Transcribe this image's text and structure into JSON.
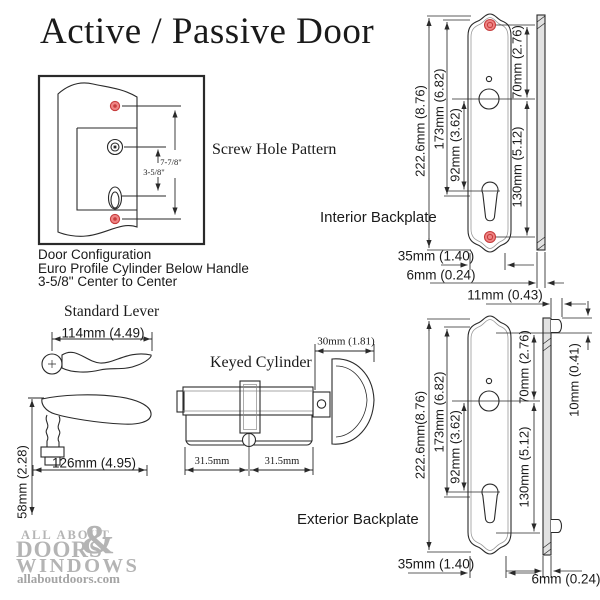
{
  "title": "Active / Passive Door",
  "screw_pattern": {
    "label": "Screw Hole Pattern",
    "dim_outer": "7-7/8\"",
    "dim_inner": "3-5/8\""
  },
  "door_config": {
    "line1": "Door Configuration",
    "line2": "Euro Profile Cylinder Below Handle",
    "line3": "3-5/8\" Center to Center"
  },
  "lever": {
    "label": "Standard Lever",
    "dim_width_top": "114mm (4.49)",
    "dim_length": "126mm (4.95)",
    "dim_height": "58mm (2.28)"
  },
  "cylinder": {
    "label": "Keyed Cylinder",
    "dim_thumbturn": "30mm (1.81)",
    "dim_left_half": "31.5mm",
    "dim_right_half": "31.5mm"
  },
  "interior_backplate": {
    "label": "Interior Backplate",
    "dim_overall_height": "222.6mm (8.76)",
    "dim_screw_spacing": "173mm (6.82)",
    "dim_handle_to_cylinder": "92mm (3.62)",
    "dim_top_to_handle": "70mm (2.76)",
    "dim_handle_to_bottom": "130mm (5.12)",
    "dim_width": "35mm (1.40)",
    "dim_thickness": "6mm (0.24)"
  },
  "exterior_backplate": {
    "label": "Exterior Backplate",
    "dim_overall_height": "222.6mm(8.76)",
    "dim_screw_spacing": "173mm (6.82)",
    "dim_handle_to_cylinder": "92mm (3.62)",
    "dim_top_to_handle": "70mm (2.76)",
    "dim_handle_to_bottom": "130mm (5.12)",
    "dim_width": "35mm (1.40)",
    "dim_thickness": "6mm (0.24)",
    "dim_tab_protrusion": "11mm (0.43)",
    "dim_tab_height": "10mm (0.41)"
  },
  "logo": {
    "line1": "ALL ABOUT",
    "line2": "DOORS",
    "ampersand": "&",
    "line3": "WINDOWS",
    "website": "allaboutdoors.com"
  },
  "colors": {
    "screw_hole_fill": "#ef8585",
    "screw_hole_ring": "#c63d3d",
    "line_color": "#2a2a2a",
    "logo_gray": "#b4b4b4"
  }
}
